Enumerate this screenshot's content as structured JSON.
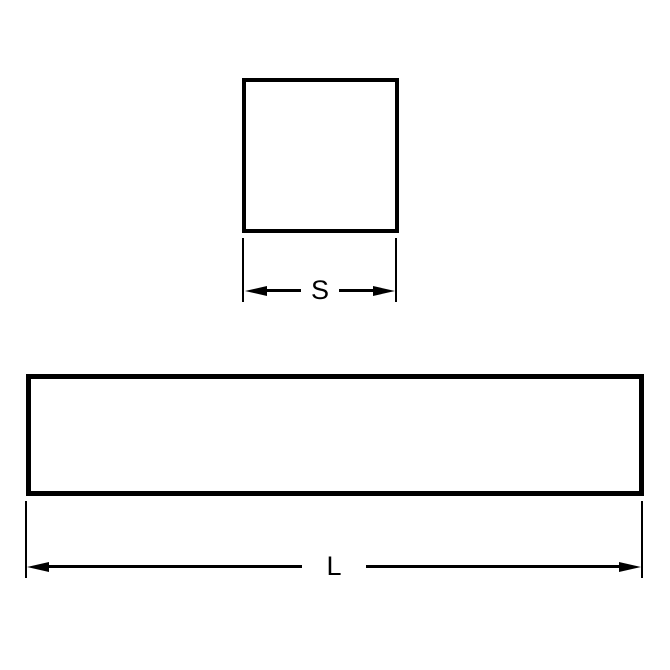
{
  "colors": {
    "background": "#ffffff",
    "line": "#000000"
  },
  "diagram": {
    "top_view": {
      "shape": "square",
      "dimension_label": "S"
    },
    "front_view": {
      "shape": "rectangle",
      "dimension_label": "L"
    }
  }
}
